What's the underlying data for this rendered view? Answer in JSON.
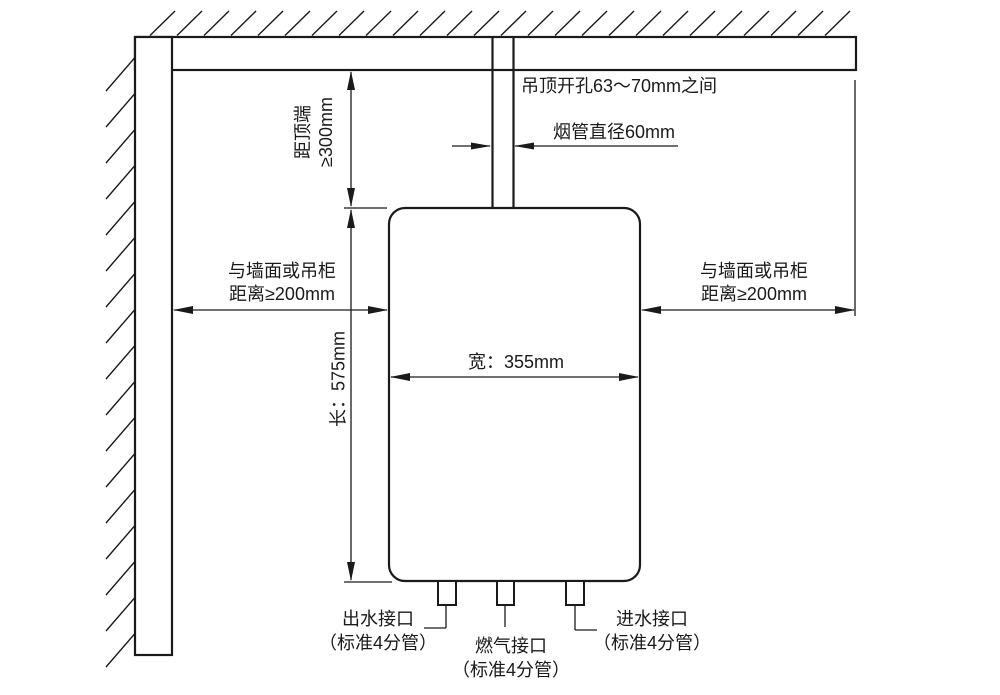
{
  "diagram": {
    "type": "installation-clearance-diagram",
    "colors": {
      "line": "#1a1a1a",
      "background": "#ffffff"
    },
    "annotations": {
      "ceiling_hole": "吊顶开孔63～70mm之间",
      "flue_diameter": "烟管直径60mm",
      "top_clearance": {
        "line1": "距顶端",
        "line2": "≥300mm"
      },
      "left_clearance": {
        "line1": "与墙面或吊柜",
        "line2": "距离≥200mm"
      },
      "right_clearance": {
        "line1": "与墙面或吊柜",
        "line2": "距离≥200mm"
      },
      "height": "长：575mm",
      "width": "宽：355mm",
      "water_outlet": {
        "line1": "出水接口",
        "line2": "（标准4分管）"
      },
      "gas_connector": {
        "line1": "燃气接口",
        "line2": "（标准4分管）"
      },
      "water_inlet": {
        "line1": "进水接口",
        "line2": "（标准4分管）"
      }
    }
  }
}
